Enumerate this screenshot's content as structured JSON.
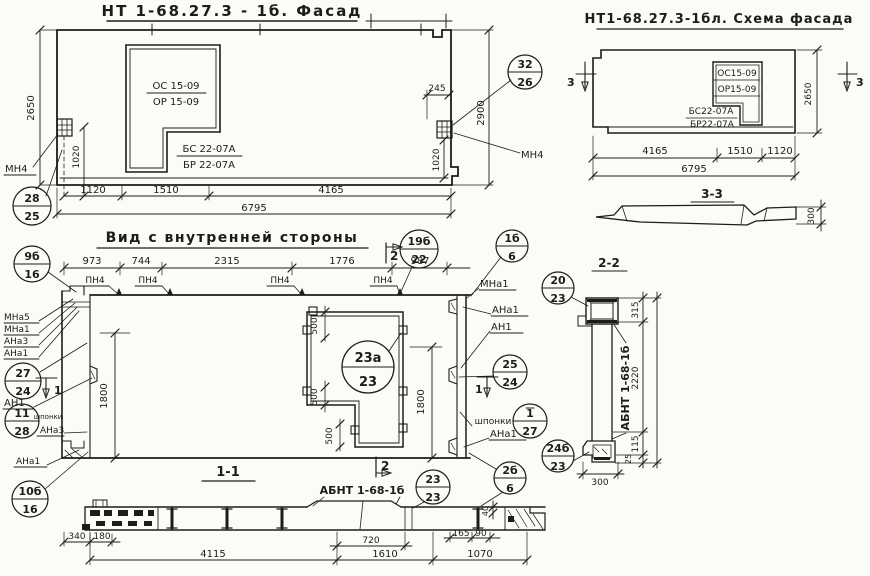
{
  "palette": {
    "ink": "#1c1c1c",
    "paper": "#fcfbf7"
  },
  "facade": {
    "title": "НТ 1-68.27.3 - 1б. Фасад",
    "window": {
      "line1": "ОС 15-09",
      "line2": "ОР 15-09",
      "line3": "БС 22-07А",
      "line4": "БР 22-07А"
    },
    "dims": {
      "seg1": "1120",
      "seg2": "1510",
      "seg3": "4165",
      "total": "6795",
      "height_left": "2650",
      "anchor_left_v": "1020",
      "anchor_right_v": "1020",
      "height_right": "2900",
      "anchor_right_offset": "245"
    },
    "labels": {
      "anchor_left": "МН4",
      "anchor_right": "МН4"
    }
  },
  "schema": {
    "title": "НТ1-68.27.3-1бл. Схема фасада",
    "window": {
      "line1": "ОС15-09",
      "line2": "ОР15-09",
      "line3": "БС22-07А",
      "line4": "БР22-07А"
    },
    "dims": {
      "seg1": "4165",
      "seg2": "1510",
      "seg3": "1120",
      "total": "6795",
      "height": "2650"
    },
    "section_mark": "3",
    "profile": {
      "title": "3-3",
      "thickness": "300"
    }
  },
  "inner": {
    "title": "Вид с внутренней стороны",
    "dims": {
      "seg1": "973",
      "seg2": "744",
      "seg3": "2315",
      "seg4": "1776",
      "seg5": "987",
      "height_left": "1800",
      "height_right": "1800",
      "win_offset": "500"
    },
    "labels": {
      "pn4": "ПН4",
      "mna5": "МНа5",
      "mna1": "МНа1",
      "ana3": "АНа3",
      "ana1": "АНа1",
      "an1": "АН1",
      "shponki": "шпонки"
    },
    "marks": {
      "cut1": "1",
      "cut2": "2"
    }
  },
  "section22": {
    "title": "2-2",
    "panel_ref": "АБНТ 1-68-1б",
    "dims": {
      "top": "315",
      "middle": "2220",
      "lower": "115",
      "bottom": "25",
      "width": "300"
    }
  },
  "section11": {
    "title": "1-1",
    "panel_ref": "АБНТ 1-68-1б",
    "dims": {
      "a": "340",
      "b": "180",
      "c": "720",
      "d": "165",
      "e": "90",
      "f": "40",
      "seg1": "4115",
      "seg2": "1610",
      "seg3": "1070"
    }
  },
  "callouts": {
    "c28_25": {
      "top": "28",
      "bottom": "25"
    },
    "c32_26": {
      "top": "32",
      "bottom": "26"
    },
    "c9b_16": {
      "top": "9б",
      "bottom": "16"
    },
    "c19b_22": {
      "top": "19б",
      "bottom": "22"
    },
    "c1b_6": {
      "top": "1б",
      "bottom": "6"
    },
    "c27_24": {
      "top": "27",
      "bottom": "24"
    },
    "c11_28": {
      "top": "11",
      "bottom": "28"
    },
    "c10b_16": {
      "top": "10б",
      "bottom": "16"
    },
    "c25_24": {
      "top": "25",
      "bottom": "24"
    },
    "c1_27": {
      "top": "1",
      "bottom": "27"
    },
    "c2b_6": {
      "top": "2б",
      "bottom": "6"
    },
    "c20_23": {
      "top": "20",
      "bottom": "23"
    },
    "c24b_23": {
      "top": "24б",
      "bottom": "23"
    },
    "c23_23": {
      "top": "23",
      "bottom": "23"
    },
    "c23a_23": {
      "top": "23а",
      "bottom": "23"
    }
  }
}
